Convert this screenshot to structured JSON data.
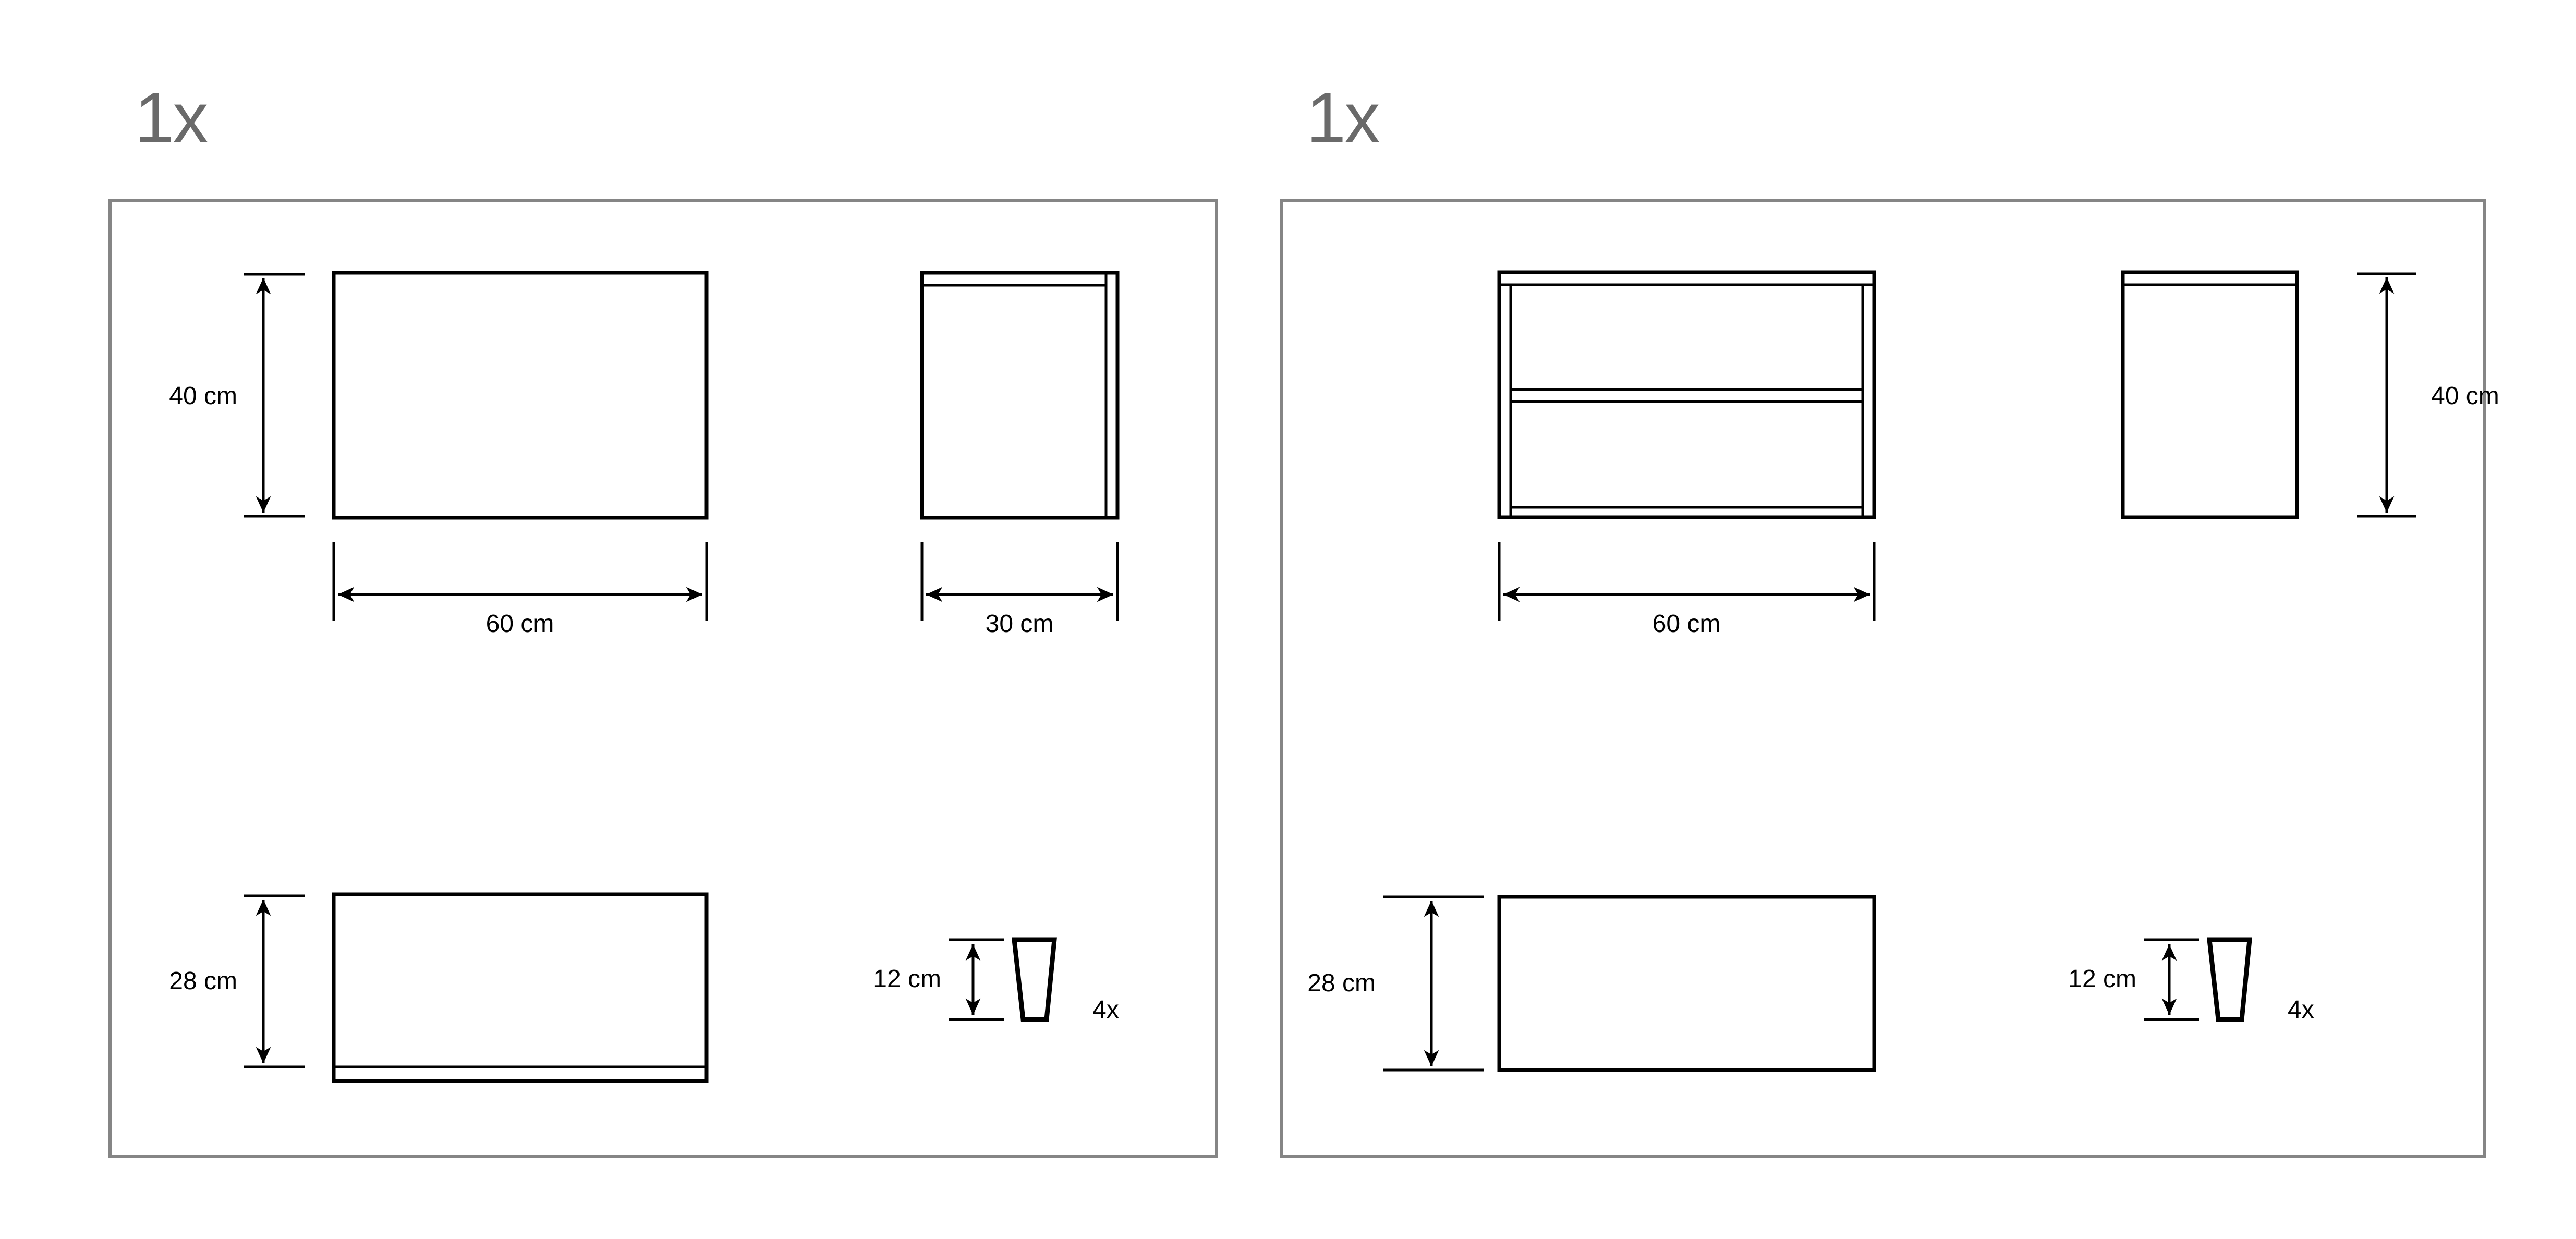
{
  "colors": {
    "background": "#ffffff",
    "drawing_line": "#000000",
    "panel_border": "#858585",
    "quantity_text": "#6a6a6a",
    "dimension_text": "#000000"
  },
  "panels": [
    {
      "quantity_label": "1x",
      "front_view": {
        "height_label": "40 cm",
        "width_label": "60 cm"
      },
      "side_view": {
        "width_label": "30 cm"
      },
      "panel_view": {
        "height_label": "28 cm"
      },
      "leg_view": {
        "height_label": "12 cm",
        "count_label": "4x"
      }
    },
    {
      "quantity_label": "1x",
      "shelf_view": {
        "width_label": "60 cm"
      },
      "side_view": {
        "height_label": "40 cm"
      },
      "panel_view": {
        "height_label": "28 cm"
      },
      "leg_view": {
        "height_label": "12 cm",
        "count_label": "4x"
      }
    }
  ]
}
